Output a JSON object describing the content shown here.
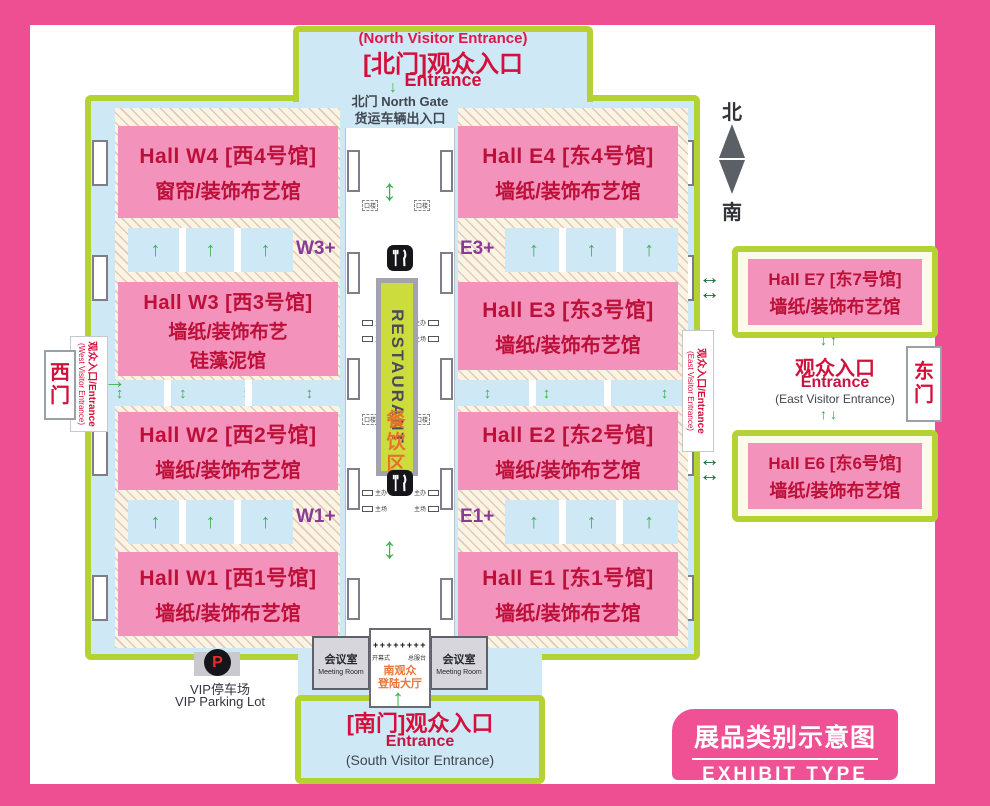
{
  "colors": {
    "band_pink": "#ee4f92",
    "hall_pink": "#f392bb",
    "hall_text_red": "#bc1038",
    "building_green": "#b5d233",
    "light_blue": "#cfe8f6",
    "entrance_red": "#d3103c",
    "zone_purple": "#8a3a96",
    "arrow_green": "#3cb44b",
    "dark_green": "#1d6b3c",
    "orange": "#e8702e"
  },
  "north_entrance": {
    "subtitle": "(North Visitor Entrance)",
    "title": "[北门]观众入口",
    "entrance": "Entrance"
  },
  "north_gate": {
    "line1": "北门 North Gate",
    "line2": "货运车辆出入口"
  },
  "compass": {
    "north": "北",
    "south": "南"
  },
  "halls": {
    "w4": {
      "name": "Hall W4 [西4号馆]",
      "type": "窗帘/装饰布艺馆"
    },
    "w3": {
      "name": "Hall W3 [西3号馆]",
      "type": "墙纸/装饰布艺",
      "type2": "硅藻泥馆"
    },
    "w2": {
      "name": "Hall W2 [西2号馆]",
      "type": "墙纸/装饰布艺馆"
    },
    "w1": {
      "name": "Hall W1 [西1号馆]",
      "type": "墙纸/装饰布艺馆"
    },
    "e4": {
      "name": "Hall E4 [东4号馆]",
      "type": "墙纸/装饰布艺馆"
    },
    "e3": {
      "name": "Hall E3 [东3号馆]",
      "type": "墙纸/装饰布艺馆"
    },
    "e2": {
      "name": "Hall E2 [东2号馆]",
      "type": "墙纸/装饰布艺馆"
    },
    "e1": {
      "name": "Hall E1 [东1号馆]",
      "type": "墙纸/装饰布艺馆"
    },
    "e7": {
      "name": "Hall E7 [东7号馆]",
      "type": "墙纸/装饰布艺馆"
    },
    "e6": {
      "name": "Hall E6 [东6号馆]",
      "type": "墙纸/装饰布艺馆"
    }
  },
  "zones": {
    "w3plus": "W3+",
    "e3plus": "E3+",
    "w1plus": "W1+",
    "e1plus": "E1+"
  },
  "restaurant": {
    "en": "RESTAURANT",
    "cn": "餐饮区"
  },
  "corridor": {
    "label_organizer": "主办",
    "label_host": "主场",
    "label_door": "口楼"
  },
  "west_gate": {
    "gate": "西门",
    "strip1": "观众入口/Entrance",
    "strip2": "(West Visitor Entrance)"
  },
  "east_gate": {
    "gate": "东门",
    "strip1": "观众入口/Entrance",
    "strip2": "(East Visitor Entrance)",
    "title": "观众入口",
    "entrance": "Entrance",
    "subtitle": "(East Visitor Entrance)"
  },
  "south_entrance": {
    "title": "[南门]观众入口",
    "entrance": "Entrance",
    "subtitle": "(South Visitor Entrance)"
  },
  "meeting_room": {
    "cn": "会议室",
    "en": "Meeting Room"
  },
  "lobby": {
    "turnstile": "++++++++",
    "left_note": "开幕式",
    "right_note": "总服台",
    "line1": "南观众",
    "line2": "登陆大厅"
  },
  "vip": {
    "symbol": "P",
    "cn": "VIP停车场",
    "en": "VIP Parking Lot"
  },
  "legend": {
    "cn": "展品类别示意图",
    "en": "EXHIBIT  TYPE"
  },
  "icons": {
    "up": "↑",
    "down": "↓",
    "updown": "↕",
    "left_right": "↔",
    "right": "→"
  }
}
